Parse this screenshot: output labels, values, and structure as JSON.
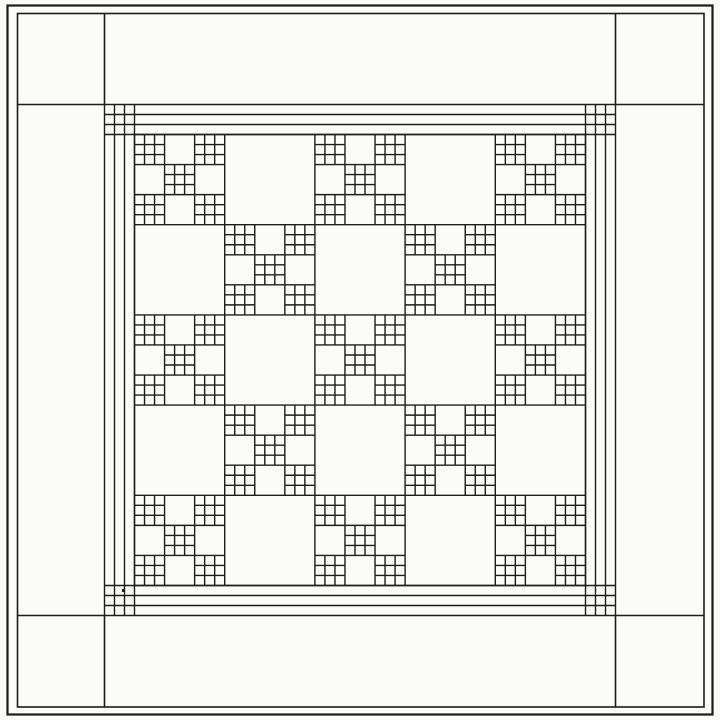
{
  "diagram": {
    "kind": "quilt-pattern-line-drawing",
    "style": "single-irish-chain",
    "canvas": {
      "width": 720,
      "height": 720,
      "background": "#fbfbf9",
      "ink": "#1c1c1a"
    },
    "strokes": {
      "outer_frame": 2.2,
      "inner_frame": 1.6,
      "line": 1.4
    },
    "outer_frame": {
      "x": 7.5,
      "y": 5.5,
      "width": 705,
      "height": 709
    },
    "inner_frame": {
      "x": 17.5,
      "y": 13.5,
      "width": 686.5,
      "height": 693.5
    },
    "border_band": {
      "corner_square_near_line": 104.5,
      "corner_square_far_line": 615.5,
      "frame_left": 17.5,
      "frame_top": 13.5,
      "frame_right": 704,
      "frame_bottom": 707
    },
    "striped_border": {
      "strip_count": 3,
      "near_lines": [
        104.5,
        114.5,
        124.5,
        134.5
      ],
      "far_lines": [
        585.5,
        595.5,
        605.5,
        615.5
      ],
      "span_start": 104.5,
      "span_end": 615.5,
      "corner_block": "three-by-three-grid"
    },
    "field": {
      "origin": 134.5,
      "end": 585.5,
      "blocks_per_side": 5,
      "layout": "checkerboard",
      "chain_rule": "row-plus-column-even",
      "chain_block": {
        "grid": 3,
        "nine_patch_positions": [
          [
            0,
            0
          ],
          [
            0,
            2
          ],
          [
            1,
            1
          ],
          [
            2,
            0
          ],
          [
            2,
            2
          ]
        ],
        "mini_grid": 3
      }
    },
    "speck": {
      "x": 122,
      "y": 589,
      "w": 2.6,
      "h": 3
    }
  }
}
